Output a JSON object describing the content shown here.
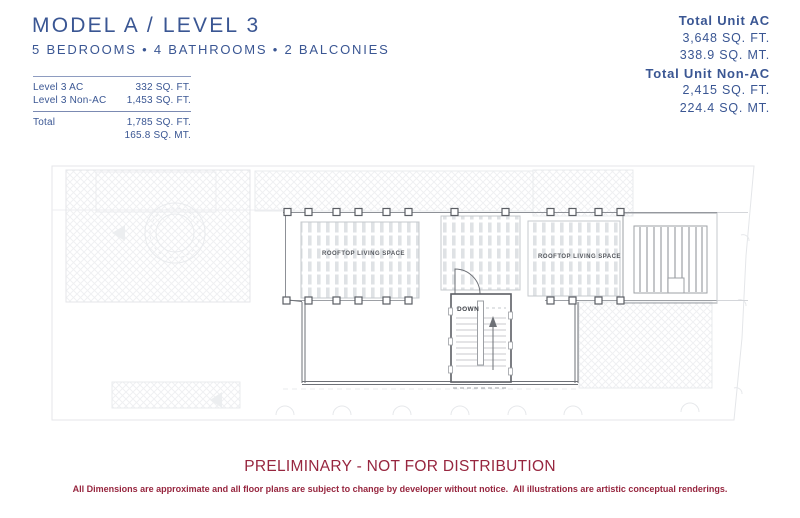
{
  "header": {
    "title": "MODEL A / LEVEL 3",
    "subtitle": "5 BEDROOMS • 4 BATHROOMS • 2 BALCONIES"
  },
  "level_table": {
    "rows": [
      {
        "label": "Level 3 AC",
        "value": "332 SQ. FT."
      },
      {
        "label": "Level 3 Non-AC",
        "value": "1,453 SQ. FT."
      }
    ],
    "total": {
      "label": "Total",
      "value_ft": "1,785 SQ. FT.",
      "value_mt": "165.8 SQ. MT."
    }
  },
  "unit_totals": {
    "ac_label": "Total Unit AC",
    "ac_ft": "3,648 SQ. FT.",
    "ac_mt": "338.9 SQ. MT.",
    "nonac_label": "Total Unit Non-AC",
    "nonac_ft": "2,415 SQ. FT.",
    "nonac_mt": "224.4 SQ. MT."
  },
  "floor_plan": {
    "labels": {
      "rooftop_left": "ROOFTOP LIVING SPACE",
      "rooftop_right": "ROOFTOP LIVING SPACE",
      "stair": "DOWN"
    }
  },
  "footer": {
    "warning": "PRELIMINARY - NOT FOR DISTRIBUTION",
    "disclaimer": "All Dimensions are approximate and all floor plans are subject to change by developer without notice.  All illustrations are artistic conceptual renderings."
  },
  "colors": {
    "brand_blue": "#3A5693",
    "warning_red": "#97263F",
    "plan_ink": "#6e7177",
    "plan_faint": "#e4e6e9"
  }
}
